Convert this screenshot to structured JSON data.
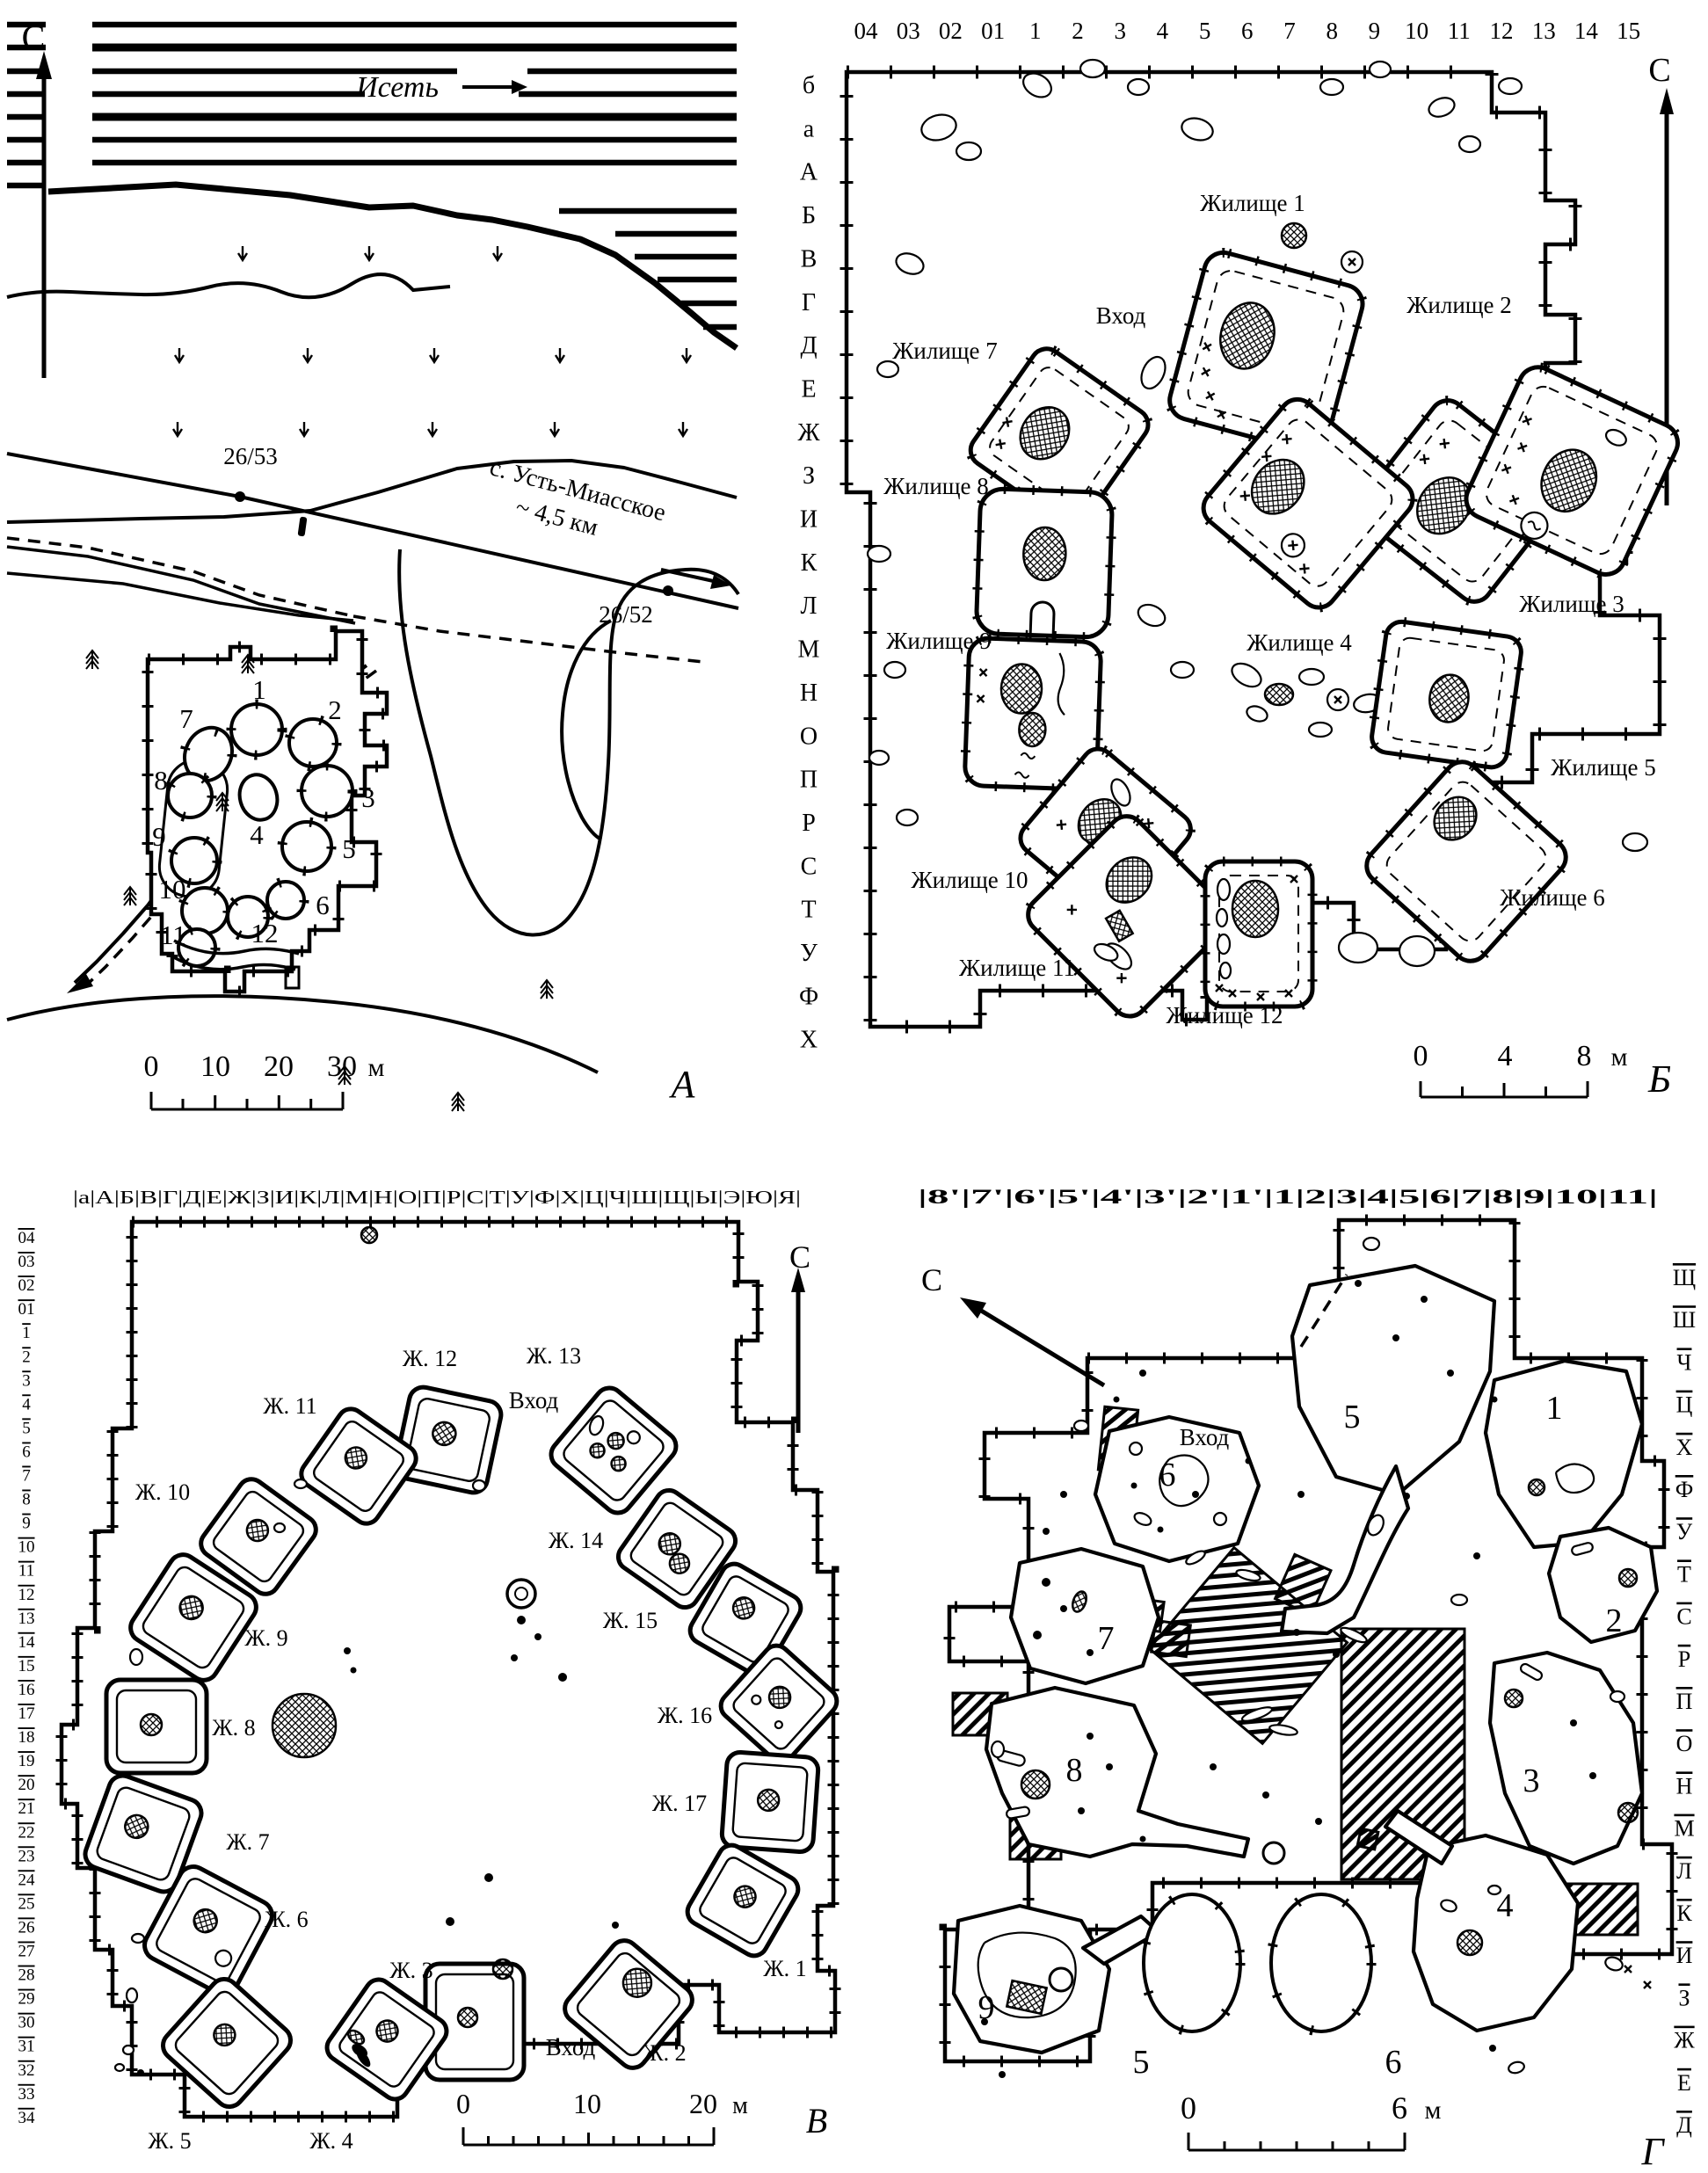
{
  "figure": {
    "panel_a": {
      "label": "А",
      "north": "С",
      "river": "Исеть",
      "benchmark_upper": "26/53",
      "benchmark_lower": "26/52",
      "village": "с. Усть-Миасское",
      "village_dist": "~ 4,5 км",
      "lake": "оз. Лесное",
      "lake_dist": "– 180 м",
      "depressions": [
        "1",
        "2",
        "3",
        "4",
        "5",
        "6",
        "7",
        "8",
        "9",
        "10",
        "11",
        "12"
      ],
      "scale": {
        "t0": "0",
        "t1": "10",
        "t2": "20",
        "t3": "30",
        "unit": "м"
      }
    },
    "panel_b": {
      "label": "Б",
      "north": "С",
      "entrance": "Вход",
      "cols": [
        "04",
        "03",
        "02",
        "01",
        "1",
        "2",
        "3",
        "4",
        "5",
        "6",
        "7",
        "8",
        "9",
        "10",
        "11",
        "12",
        "13",
        "14",
        "15"
      ],
      "rows": [
        "б",
        "а",
        "А",
        "Б",
        "В",
        "Г",
        "Д",
        "Е",
        "Ж",
        "З",
        "И",
        "К",
        "Л",
        "М",
        "Н",
        "О",
        "П",
        "Р",
        "С",
        "Т",
        "У",
        "Ф",
        "Х"
      ],
      "dwellings": [
        "Жилище 1",
        "Жилище 2",
        "Жилище 3",
        "Жилище 4",
        "Жилище 5",
        "Жилище 6",
        "Жилище 7",
        "Жилище 8",
        "Жилище 9",
        "Жилище 10",
        "Жилище 11",
        "Жилище 12"
      ],
      "scale": {
        "t0": "0",
        "t1": "4",
        "t2": "8",
        "unit": "м"
      }
    },
    "panel_v": {
      "label": "В",
      "north": "С",
      "entrance_top": "Вход",
      "entrance_bottom": "Вход",
      "col_header": "|а|А|Б|В|Г|Д|Е|Ж|З|И|К|Л|М|Н|О|П|Р|С|Т|У|Ф|Х|Ц|Ч|Ш|Щ|Ы|Э|Ю|Я|",
      "rows": [
        "04",
        "03",
        "02",
        "01",
        "1",
        "2",
        "3",
        "4",
        "5",
        "6",
        "7",
        "8",
        "9",
        "10",
        "11",
        "12",
        "13",
        "14",
        "15",
        "16",
        "17",
        "18",
        "19",
        "20",
        "21",
        "22",
        "23",
        "24",
        "25",
        "26",
        "27",
        "28",
        "29",
        "30",
        "31",
        "32",
        "33",
        "34"
      ],
      "dwellings": [
        "Ж. 1",
        "Ж. 2",
        "Ж. 3",
        "Ж. 4",
        "Ж. 5",
        "Ж. 6",
        "Ж. 7",
        "Ж. 8",
        "Ж. 9",
        "Ж. 10",
        "Ж. 11",
        "Ж. 12",
        "Ж. 13",
        "Ж. 14",
        "Ж. 15",
        "Ж. 16",
        "Ж. 17"
      ],
      "scale": {
        "t0": "0",
        "t1": "10",
        "t2": "20",
        "unit": "м"
      }
    },
    "panel_g": {
      "label": "Г",
      "north": "С",
      "entrance": "Вход",
      "col_header": "|8'|7'|6'|5'|4'|3'|2'|1'|1|2|3|4|5|6|7|8|9|10|11|",
      "rows": [
        "Щ",
        "Ш",
        "Ч",
        "Ц",
        "Х",
        "Ф",
        "У",
        "Т",
        "С",
        "Р",
        "П",
        "О",
        "Н",
        "М",
        "Л",
        "К",
        "И",
        "З",
        "Ж",
        "Е",
        "Д"
      ],
      "features": [
        "1",
        "2",
        "3",
        "4",
        "5",
        "6",
        "7",
        "8",
        "9"
      ],
      "pits": [
        "5",
        "6"
      ],
      "scale": {
        "t0": "0",
        "t1": "6",
        "unit": "м"
      }
    }
  }
}
